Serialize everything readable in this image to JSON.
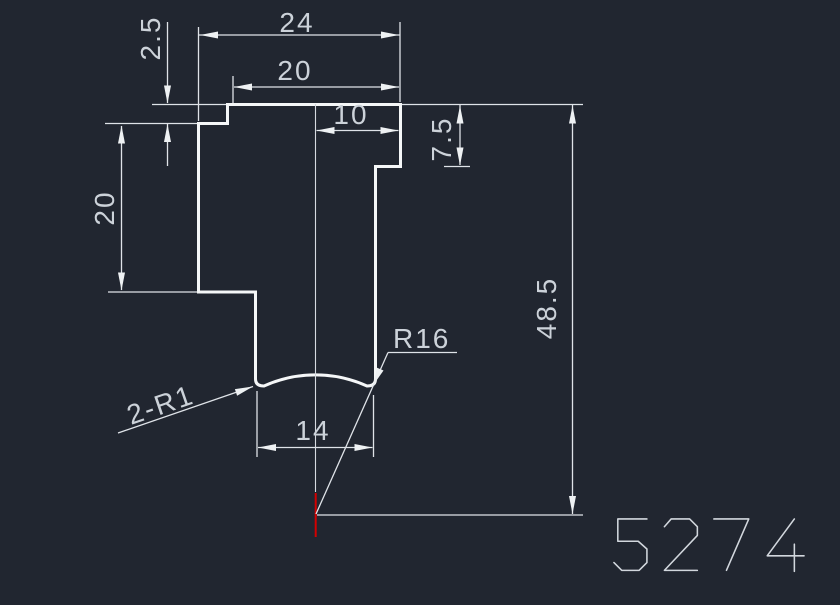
{
  "drawing": {
    "number": "5274",
    "colors": {
      "background": "#212630",
      "geometry": "#f5f7f8",
      "dimension_lines": "#dfe3e8",
      "text": "#ccd2d9",
      "center_mark": "#d40000"
    },
    "dimensions": {
      "overall_width": "24",
      "top_width": "20",
      "step_height": "2.5",
      "center_to_right": "10",
      "right_step_depth": "7.5",
      "left_height": "20",
      "overall_height": "48.5",
      "slot_width": "14",
      "arc_radius": "R16",
      "fillet_radius": "2-R1"
    }
  }
}
